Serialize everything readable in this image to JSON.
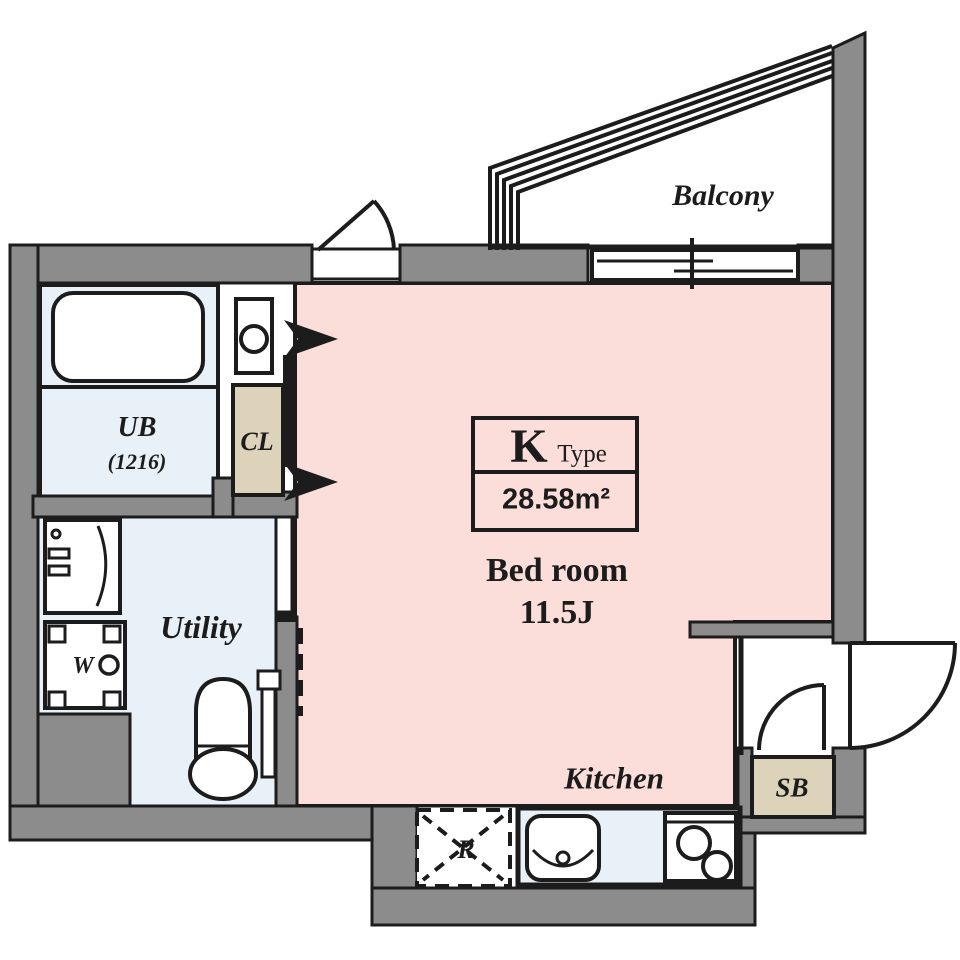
{
  "title": "K Type floor plan",
  "unit_info": {
    "type_letter": "K",
    "type_word": "Type",
    "area": "28.58m²"
  },
  "rooms": {
    "balcony": {
      "label": "Balcony"
    },
    "bedroom": {
      "label": "Bed room",
      "size": "11.5J"
    },
    "kitchen": {
      "label": "Kitchen"
    },
    "utility": {
      "label": "Utility"
    },
    "unit_bath": {
      "label": "UB",
      "size": "(1216)"
    },
    "closet": {
      "label": "CL"
    },
    "shoe_box": {
      "label": "SB"
    },
    "washer_place": {
      "label": "W"
    },
    "refrigerator_place": {
      "label": "R"
    }
  },
  "colors": {
    "wall": "#8c8c8c",
    "line": "#1c1c1c",
    "bedroom_floor": "#fbded9",
    "wet_floor": "#e7f1f7",
    "storage": "#ddd3ba",
    "bg": "#ffffff"
  }
}
